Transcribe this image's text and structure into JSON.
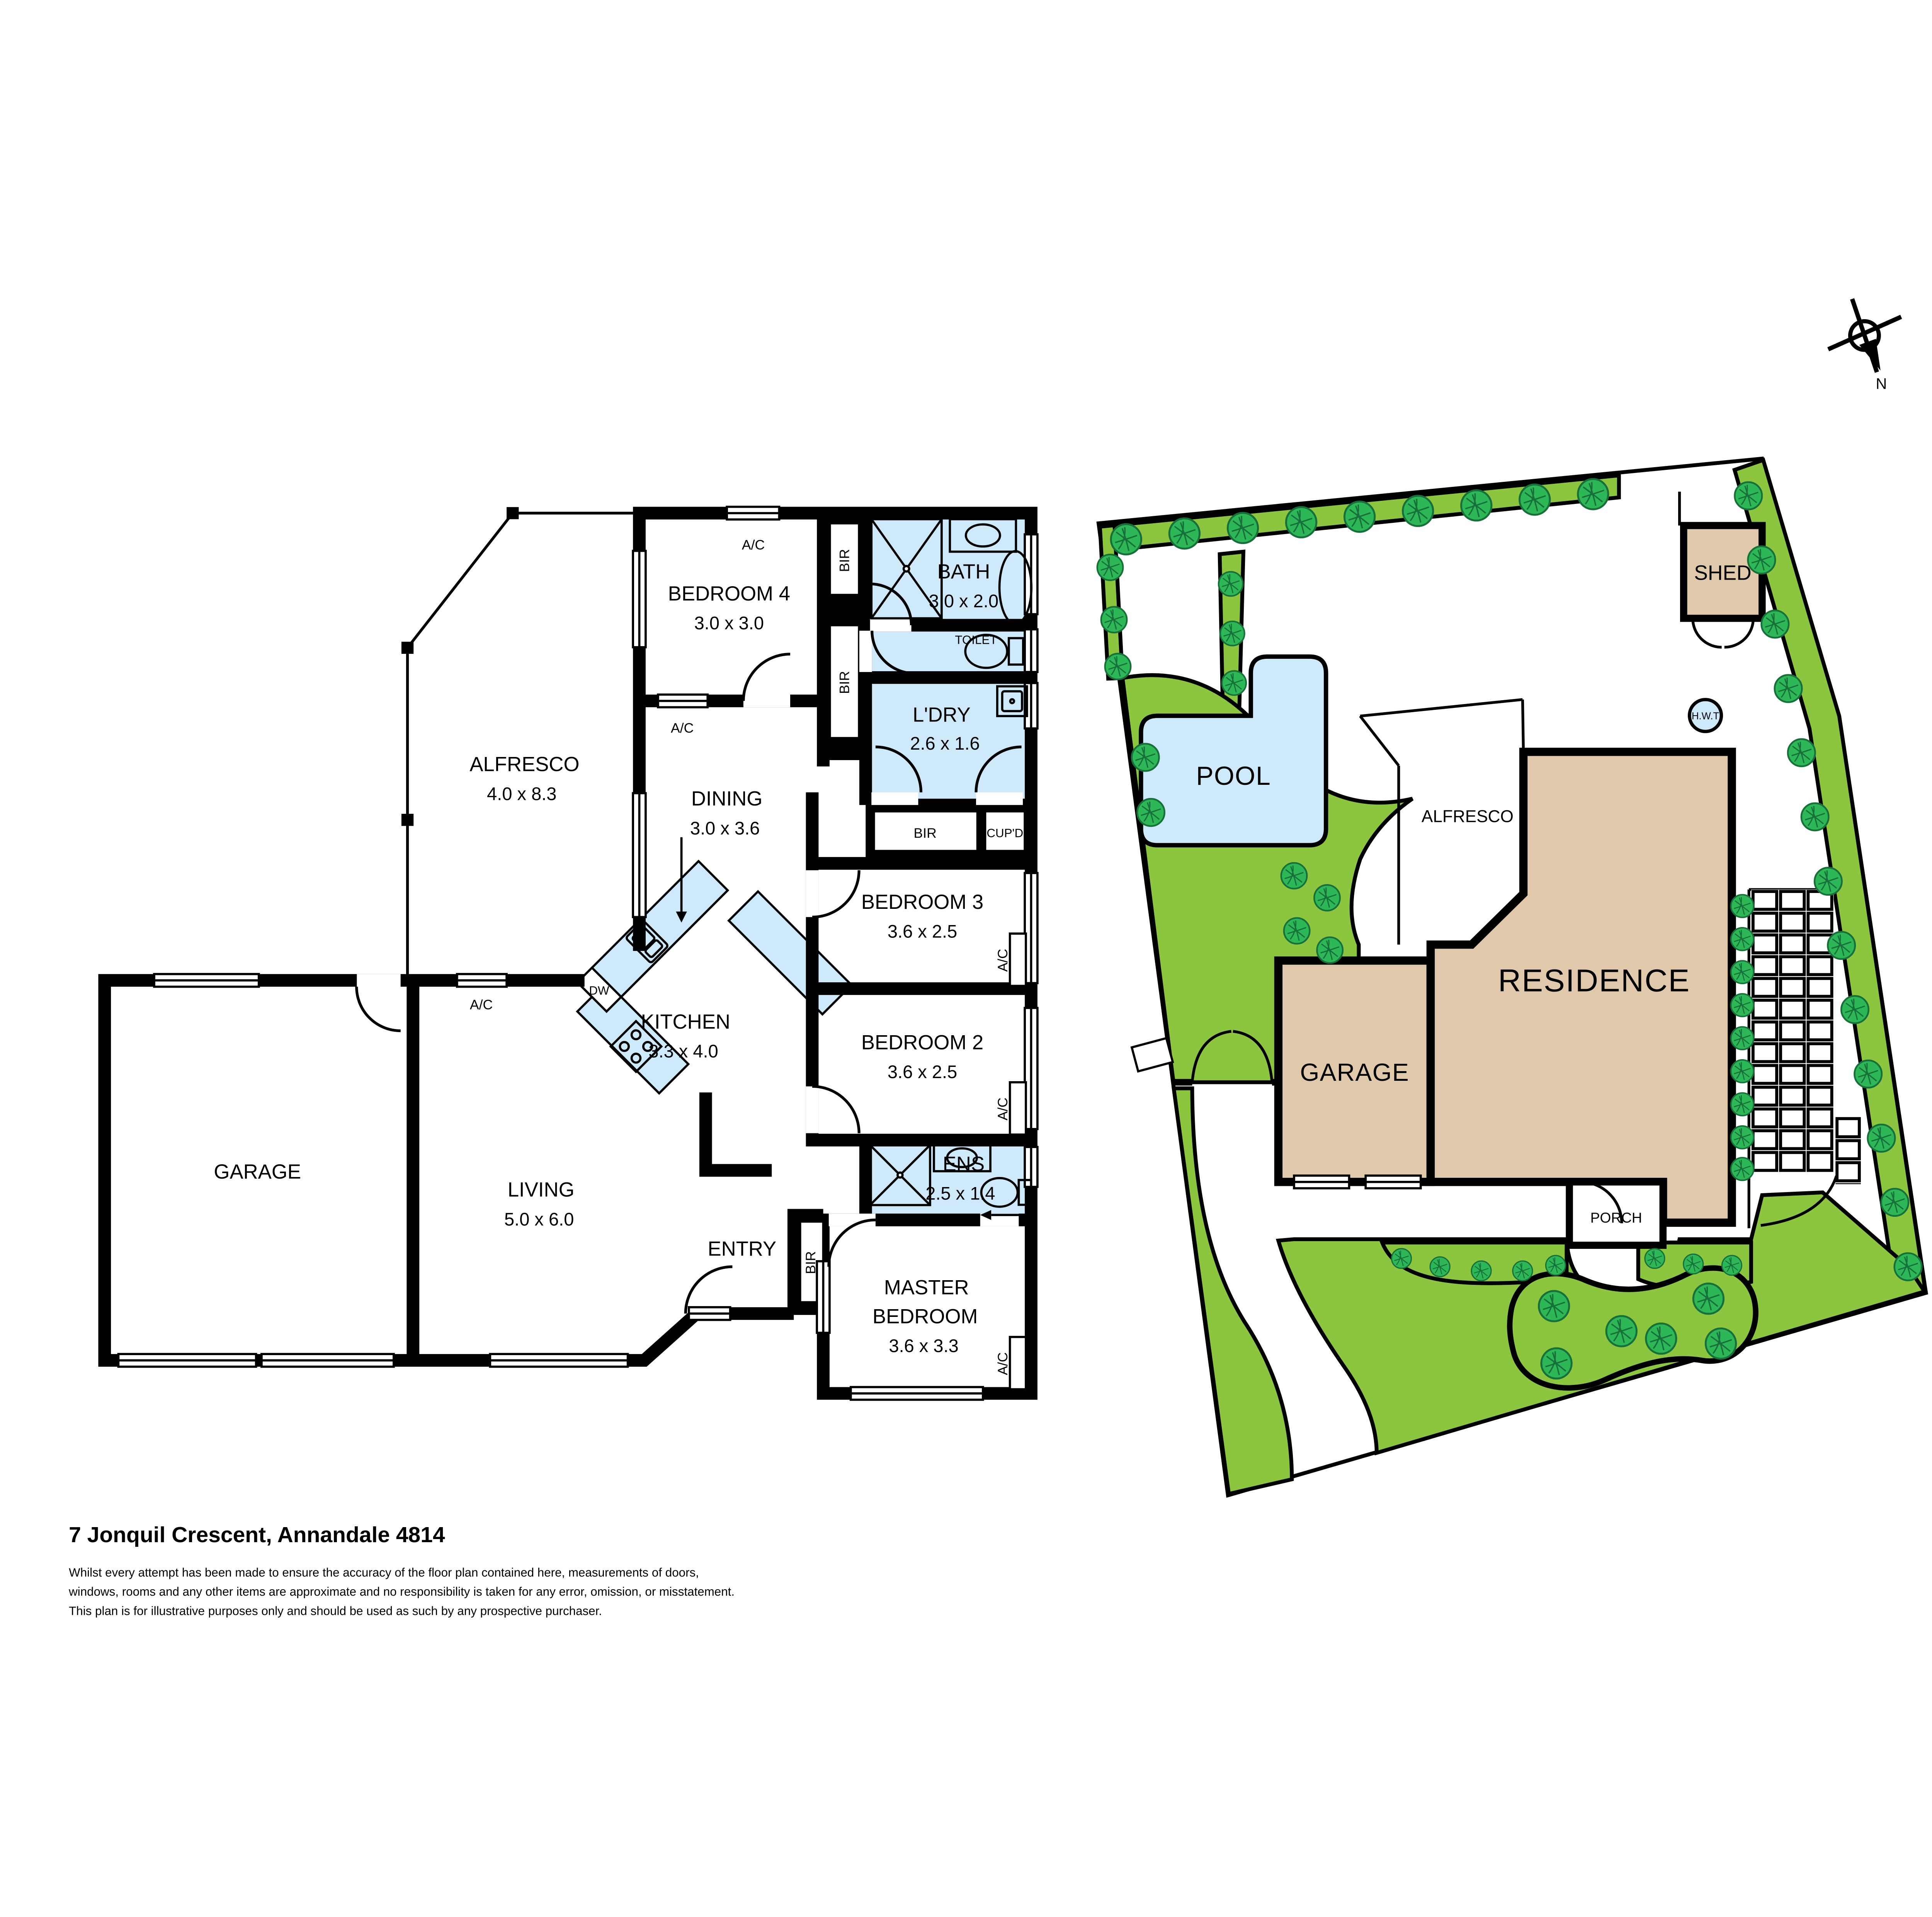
{
  "floorplan": {
    "alfresco": {
      "name": "ALFRESCO",
      "dim": "4.0 x 8.3"
    },
    "bedroom4": {
      "name": "BEDROOM 4",
      "dim": "3.0 x 3.0"
    },
    "bath": {
      "name": "BATH",
      "dim": "3.0 x 2.0"
    },
    "toilet": {
      "name": "TOILET"
    },
    "laundry": {
      "name": "L'DRY",
      "dim": "2.6 x 1.6"
    },
    "bir": "BIR",
    "cupboard": "CUP'D",
    "bedroom3": {
      "name": "BEDROOM 3",
      "dim": "3.6 x 2.5"
    },
    "bedroom2": {
      "name": "BEDROOM 2",
      "dim": "3.6 x 2.5"
    },
    "dining": {
      "name": "DINING",
      "dim": "3.0 x 3.6"
    },
    "kitchen": {
      "name": "KITCHEN",
      "dim": "3.3 x 4.0"
    },
    "dw": "DW",
    "garage": {
      "name": "GARAGE"
    },
    "living": {
      "name": "LIVING",
      "dim": "5.0 x 6.0"
    },
    "entry": {
      "name": "ENTRY"
    },
    "ensuite": {
      "name": "ENS",
      "dim": "2.5 x 1.4"
    },
    "master": {
      "line1": "MASTER",
      "line2": "BEDROOM",
      "dim": "3.6 x 3.3"
    },
    "ac": "A/C"
  },
  "siteplan": {
    "pool": "POOL",
    "shed": "SHED",
    "hwt": "H.W.T",
    "alfresco": "ALFRESCO",
    "garage": "GARAGE",
    "residence": "RESIDENCE",
    "porch": "PORCH"
  },
  "compass": {
    "north": "N"
  },
  "footer": {
    "address": "7 Jonquil Crescent, Annandale 4814",
    "line1": "Whilst every attempt has been made to ensure the accuracy of the floor plan contained here, measurements of doors,",
    "line2": "windows, rooms and any other items are approximate and no responsibility is taken for any error, omission, or misstatement.",
    "line3": "This plan is for illustrative purposes only and should be used as such by any prospective purchaser."
  },
  "colors": {
    "lawn": "#8CC63F",
    "water": "#CDE9FA",
    "building": "#DFC9AA",
    "tree": "#2DB757",
    "walls": "#000000"
  }
}
